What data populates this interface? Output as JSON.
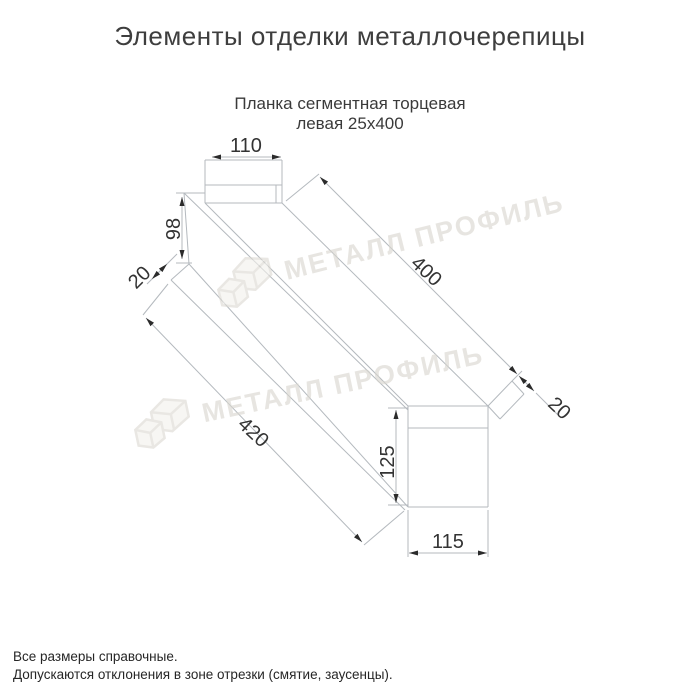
{
  "title": "Элементы отделки металлочерепицы",
  "subtitle": {
    "line1": "Планка сегментная торцевая",
    "line2": "левая 25х400"
  },
  "watermark": {
    "text": "МЕТАЛЛ ПРОФИЛЬ"
  },
  "drawing": {
    "product": "Планка сегментная торцевая левая 25х400",
    "dimensions": {
      "top_flange_width": "110",
      "left_end_height": "98",
      "left_hem": "20",
      "length": "400",
      "right_hem": "20",
      "bottom_length": "420",
      "right_end_height": "125",
      "right_end_width": "115"
    },
    "colors": {
      "line": "#b4b9be",
      "dimension_text": "#333333",
      "arrow": "#2b2b2b",
      "watermark": "#d9d6cf",
      "background": "#ffffff"
    }
  },
  "footer": {
    "line1": "Все размеры справочные.",
    "line2": "Допускаются отклонения в зоне отрезки (смятие, заусенцы)."
  }
}
